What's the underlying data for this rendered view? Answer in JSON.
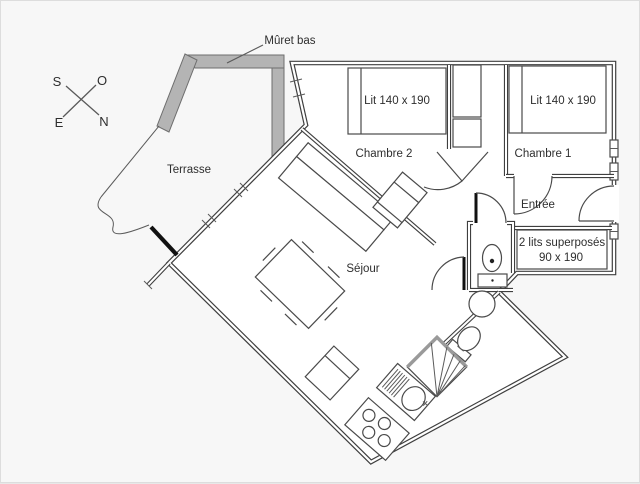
{
  "colors": {
    "background": "#f7f7f7",
    "walls": "#3f3f3f",
    "muret_fill": "#b4b4b4",
    "accent_black": "#111111"
  },
  "compass": {
    "s": "S",
    "o": "O",
    "e": "E",
    "n": "N"
  },
  "annotations": {
    "muret_bas": "Mûret bas"
  },
  "rooms": {
    "terrasse": {
      "label": "Terrasse"
    },
    "chambre2": {
      "label": "Chambre 2",
      "bed": "Lit 140 x 190"
    },
    "chambre1": {
      "label": "Chambre 1",
      "bed": "Lit 140 x 190"
    },
    "sejour": {
      "label": "Séjour"
    },
    "entree": {
      "label": "Entrée"
    },
    "bunk": {
      "label_line1": "2 lits superposés",
      "label_line2": "90 x 190"
    }
  }
}
